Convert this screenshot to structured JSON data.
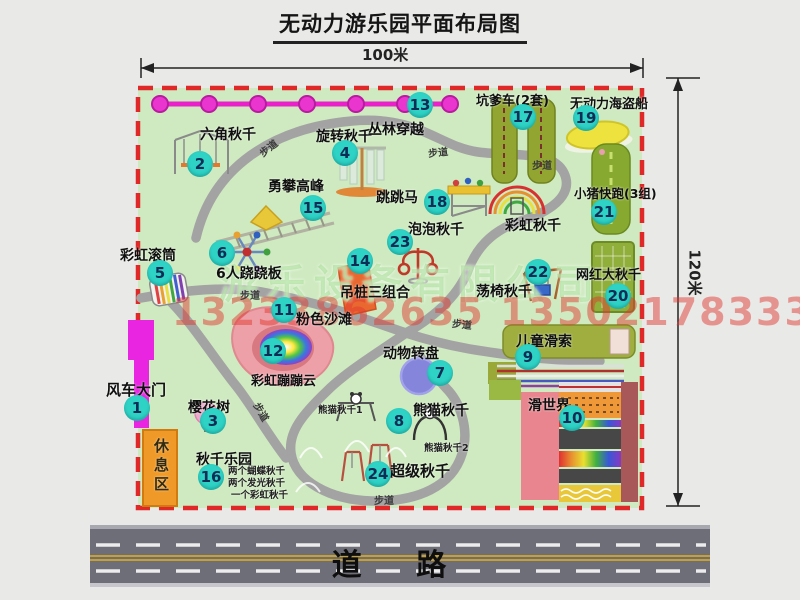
{
  "title": "无动力游乐园平面布局图",
  "dimensions": {
    "top": "100米",
    "right": "120米"
  },
  "road": {
    "label": "道  路"
  },
  "watermark": {
    "company": "游乐设备有限公司",
    "phones": "13233862635 13502178333"
  },
  "walkway": {
    "label": "步道"
  },
  "annotations": {
    "rest_area": "休息区",
    "rainbow_swing": "彩虹秋千",
    "panda_swing_1": "熊猫秋千1",
    "panda_swing_2": "熊猫秋千2",
    "swing_park_note_1": "两个蝴蝶秋千",
    "swing_park_note_2": "两个发光秋千",
    "swing_park_note_3": "一个彩虹秋千"
  },
  "items": [
    {
      "num": "1",
      "label": "风车大门"
    },
    {
      "num": "2",
      "label": "六角秋千"
    },
    {
      "num": "3",
      "label": "樱花树"
    },
    {
      "num": "4",
      "label": "旋转秋千"
    },
    {
      "num": "5",
      "label": "彩虹滚筒"
    },
    {
      "num": "6",
      "label": "6人跷跷板"
    },
    {
      "num": "7",
      "label": "动物转盘"
    },
    {
      "num": "8",
      "label": "熊猫秋千"
    },
    {
      "num": "9",
      "label": "儿童滑索"
    },
    {
      "num": "10",
      "label": "滑世界"
    },
    {
      "num": "11",
      "label": "粉色沙滩"
    },
    {
      "num": "12",
      "label": "彩虹蹦蹦云"
    },
    {
      "num": "13",
      "label": "丛林穿越"
    },
    {
      "num": "14",
      "label": "吊桩三组合"
    },
    {
      "num": "15",
      "label": "勇攀高峰"
    },
    {
      "num": "16",
      "label": "秋千乐园"
    },
    {
      "num": "17",
      "label": "坑爹车(2套)"
    },
    {
      "num": "18",
      "label": "跳跳马"
    },
    {
      "num": "19",
      "label": "无动力海盗船"
    },
    {
      "num": "20",
      "label": "网红大秋千"
    },
    {
      "num": "21",
      "label": "小猪快跑(3组)"
    },
    {
      "num": "22",
      "label": "荡椅秋千"
    },
    {
      "num": "23",
      "label": "泡泡秋千"
    },
    {
      "num": "24",
      "label": "超级秋千"
    }
  ]
}
